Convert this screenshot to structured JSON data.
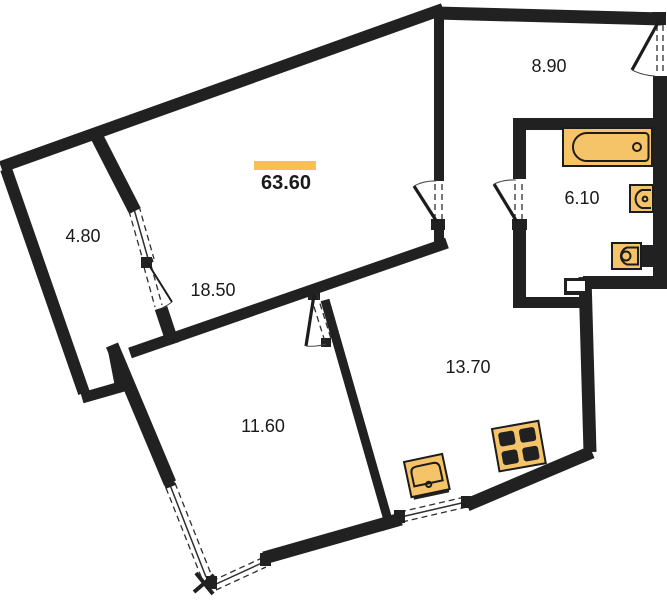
{
  "title": "Apartment floor plan",
  "total": {
    "label": "63.60"
  },
  "rooms": [
    {
      "id": "living-room",
      "area": "18.50"
    },
    {
      "id": "loggia",
      "area": "4.80"
    },
    {
      "id": "hallway",
      "area": "8.90"
    },
    {
      "id": "bathroom",
      "area": "6.10"
    },
    {
      "id": "bedroom",
      "area": "11.60"
    },
    {
      "id": "kitchen",
      "area": "13.70"
    }
  ],
  "fixtures": [
    "bathtub",
    "wall-sink",
    "toilet",
    "kitchen-sink",
    "stove"
  ],
  "colors": {
    "wall": "#212121",
    "fixture": "#F5C469",
    "fixture-stroke": "#1c1c1c",
    "accent": "#F9BE55",
    "text": "#1a1a1a",
    "bg": "#ffffff"
  }
}
